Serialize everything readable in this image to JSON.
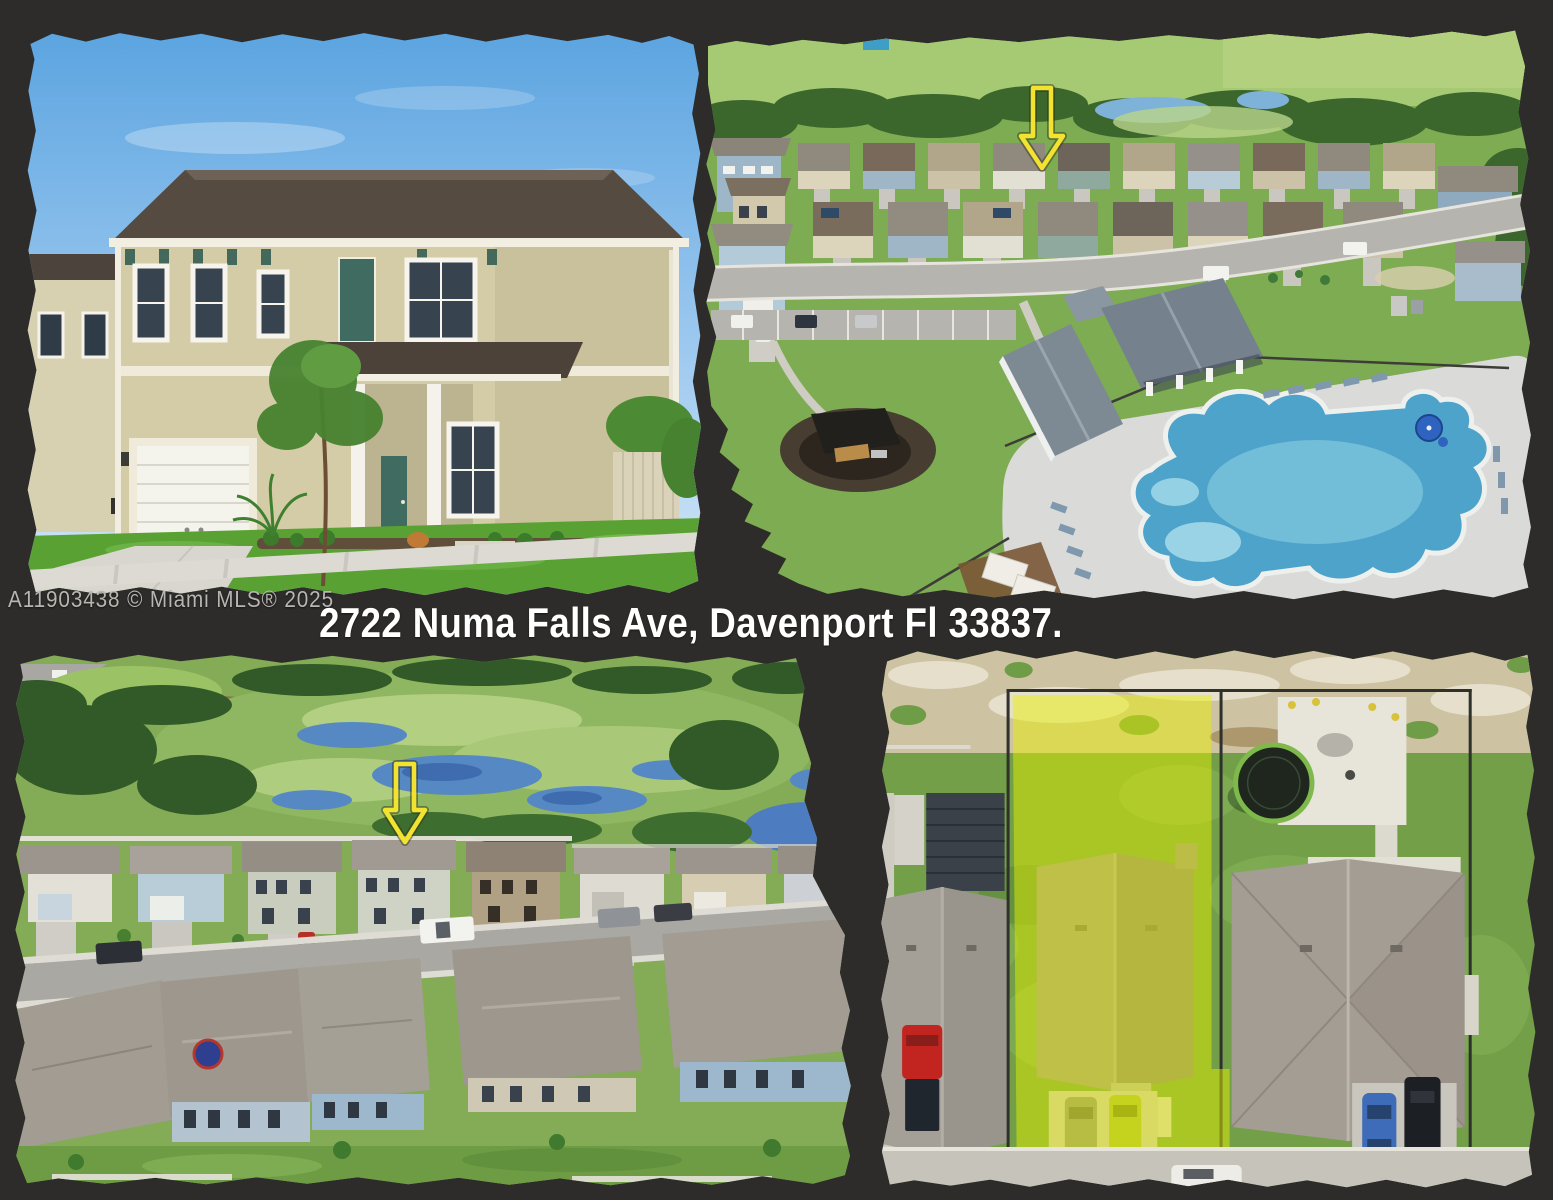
{
  "colors": {
    "bg": "#2d2c2b",
    "address_color": "#ffffff",
    "watermark_color": "#b9b5b1",
    "arrow_yellow": "#f1e32f",
    "lot_highlight": "#e9f000"
  },
  "watermark": {
    "text": "A11903438 © Miami MLS® 2025"
  },
  "address_banner": {
    "text": "2722 Numa Falls Ave, Davenport Fl 33837."
  },
  "photos": [
    {
      "alt": "Front exterior of two-story tan home with two-car garage"
    },
    {
      "alt": "Aerial view of community with clubhouse, resort pool and playground; yellow arrow marks the home"
    },
    {
      "alt": "Aerial view of homes backing to wetland preserve; yellow arrow marks the home"
    },
    {
      "alt": "Overhead aerial view with the subject lot highlighted in yellow"
    }
  ]
}
